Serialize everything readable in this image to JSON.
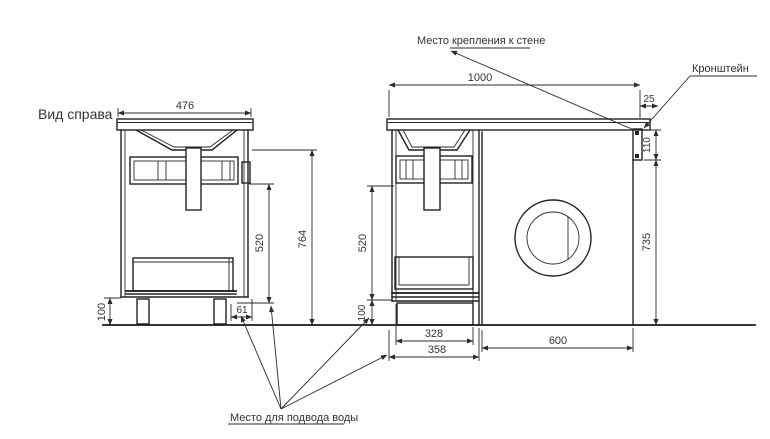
{
  "view_label": "Вид справа",
  "annotations": {
    "wall_mount_label": "Место крепления к стене",
    "bracket_label": "Кронштейн",
    "water_supply_label": "Место для подвода воды"
  },
  "dimensions": {
    "side_view": {
      "top_width": "476",
      "inner_height": "520",
      "total_height": "764",
      "plinth_height": "100",
      "rear_offset": "61"
    },
    "front_view": {
      "total_width": "1000",
      "edge_offset": "25",
      "bracket_height": "110",
      "under_top_height": "735",
      "inner_height": "520",
      "plinth_height": "100",
      "cabinet_inner_width": "328",
      "cabinet_outer_width": "358",
      "machine_width": "600"
    }
  },
  "colors": {
    "background": "#ffffff",
    "line": "#222222",
    "text": "#333333"
  }
}
